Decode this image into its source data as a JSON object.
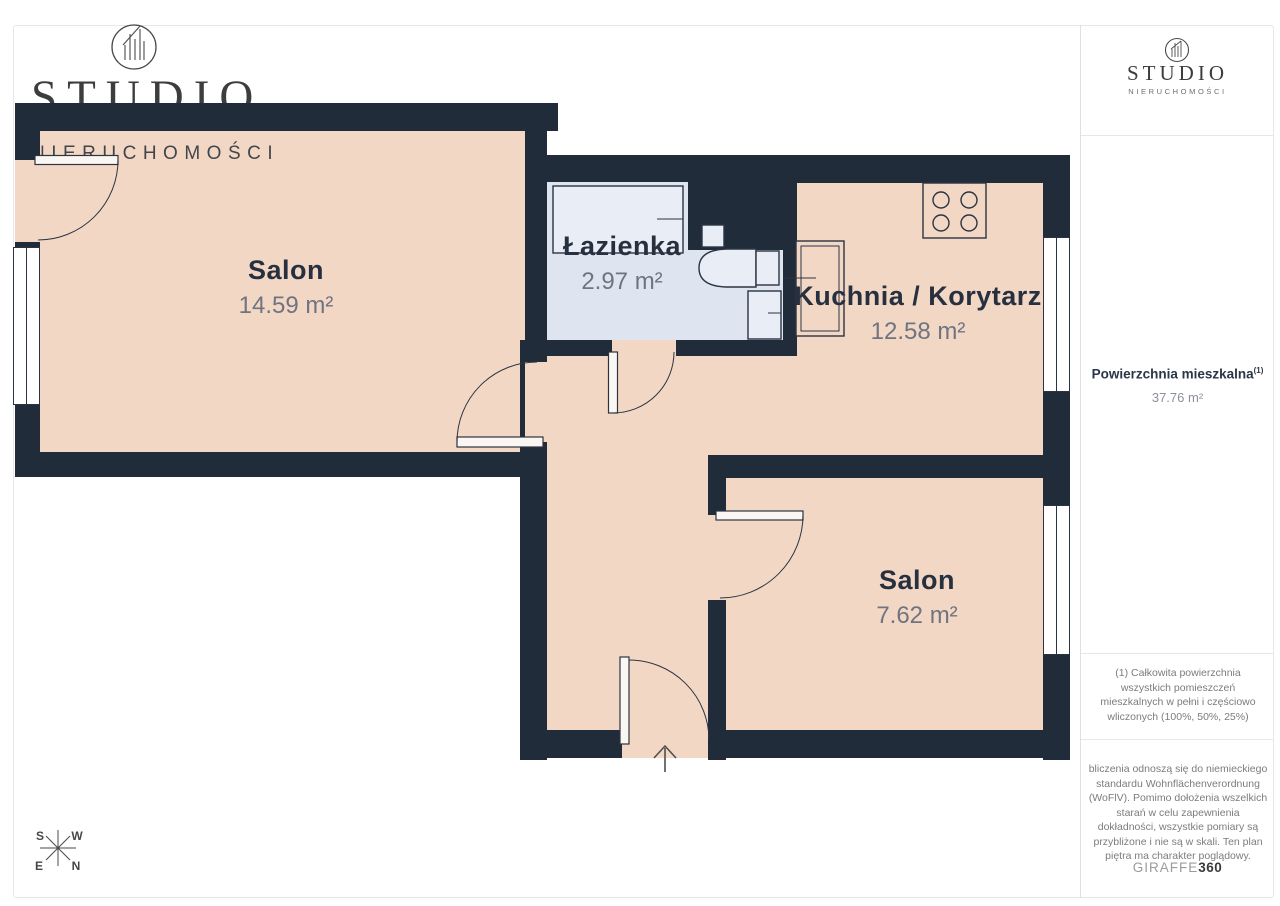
{
  "watermark": {
    "brand": "STUDIO",
    "subtitle": "NIERUCHOMOŚCI"
  },
  "plan": {
    "rooms": [
      {
        "id": "salon-1",
        "name": "Salon",
        "area": "14.59 m²"
      },
      {
        "id": "lazienka",
        "name": "Łazienka",
        "area": "2.97 m²"
      },
      {
        "id": "kuchnia",
        "name": "Kuchnia / Korytarz",
        "area": "12.58 m²"
      },
      {
        "id": "salon-2",
        "name": "Salon",
        "area": "7.62 m²"
      }
    ],
    "compass": {
      "s": "S",
      "w": "W",
      "e": "E",
      "n": "N"
    }
  },
  "sidebar": {
    "logo": {
      "brand": "STUDIO",
      "subtitle": "NIERUCHOMOŚCI"
    },
    "area": {
      "title": "Powierzchnia mieszkalna",
      "footnote_ref": "(1)",
      "value": "37.76 m²"
    },
    "footnote_1": "(1) Całkowita powierzchnia wszystkich pomieszczeń mieszkalnych w pełni i częściowo wliczonych (100%, 50%, 25%)",
    "footnote_2": "bliczenia odnoszą się do niemieckiego standardu Wohnflächenverordnung (WoFlV). Pomimo dołożenia wszelkich starań w celu zapewnienia dokładności, wszystkie pomiary są przybliżone i nie są w skali. Ten plan piętra ma charakter poglądowy.",
    "vendor": {
      "name": "GIRAFFE",
      "suffix": "360"
    }
  },
  "theme": {
    "wall": "#212c3b",
    "floor": "#f3d7c5",
    "bath": "#dfe5f0",
    "fixture": "#e9edf6",
    "outline": "#2b3442",
    "label": "#26303f",
    "muted": "#6e7480",
    "card-border": "#e7e7e7"
  }
}
